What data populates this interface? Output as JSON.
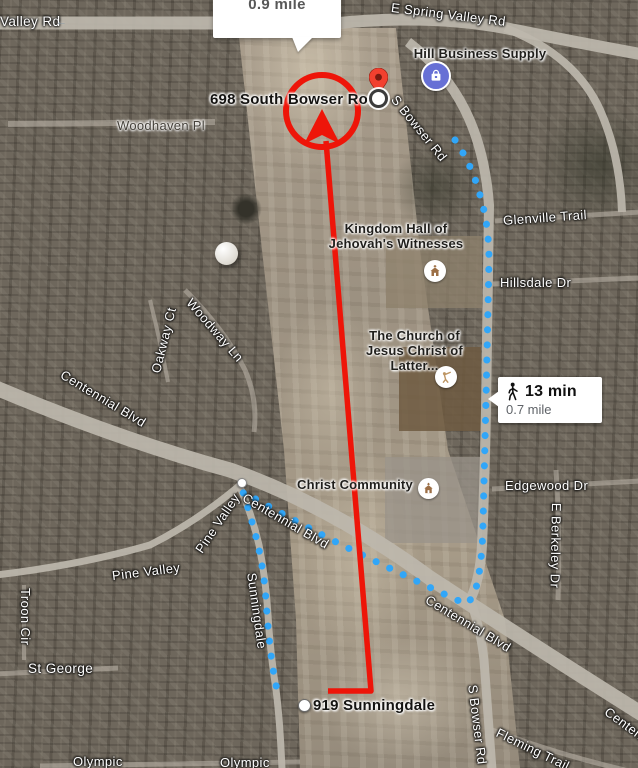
{
  "app": {
    "description": "satellite map with walking route and red annotation arrow"
  },
  "callout": {
    "distance": "0.9 mile"
  },
  "route_badge": {
    "duration": "13 min",
    "distance": "0.7 mile",
    "mode": "walking"
  },
  "markers": {
    "destination_label": "698 South Bowser Road",
    "origin_label": "919 Sunningdale"
  },
  "pois": {
    "hill_business_supply": "Hill Business Supply",
    "kingdom_hall": "Kingdom Hall of\nJehovah's Witnesses",
    "lds_church": "The Church of\nJesus Christ of Latter...",
    "christ_community": "Christ Community"
  },
  "streets": {
    "valley_rd": "Valley Rd",
    "e_spring_valley_rd": "E Spring Valley Rd",
    "s_bowser_rd": "S Bowser Rd",
    "woodhaven_pl": "Woodhaven Pl",
    "glenville_trail": "Glenville Trail",
    "hillsdale_dr": "Hillsdale Dr",
    "woodway_ln": "Woodway Ln",
    "oakway_ct": "Oakway Ct",
    "centennial_blvd": "Centennial Blvd",
    "pine_valley": "Pine Valley",
    "sunningdale": "Sunningdale",
    "troon_cir": "Troon Cir",
    "st_george": "St George",
    "edgewood_dr": "Edgewood Dr",
    "e_berkeley_dr": "E Berkeley Dr",
    "fleming_trail": "Fleming Trail",
    "olympic": "Olympic"
  },
  "icons": {
    "one_way_arrow": "←"
  },
  "colors": {
    "route_blue": "#31a6f8",
    "annotation_red": "#ee1509",
    "pin_red": "#f2402f",
    "pin_dark": "#7a1a10",
    "poi_icon_purple": "#6770d5",
    "church_brown": "#9c6f46",
    "lds_tan": "#bd9563",
    "road_gray": "#bdb7ac",
    "badge_duration_color": "#111111",
    "badge_distance_color": "#5f6368"
  }
}
